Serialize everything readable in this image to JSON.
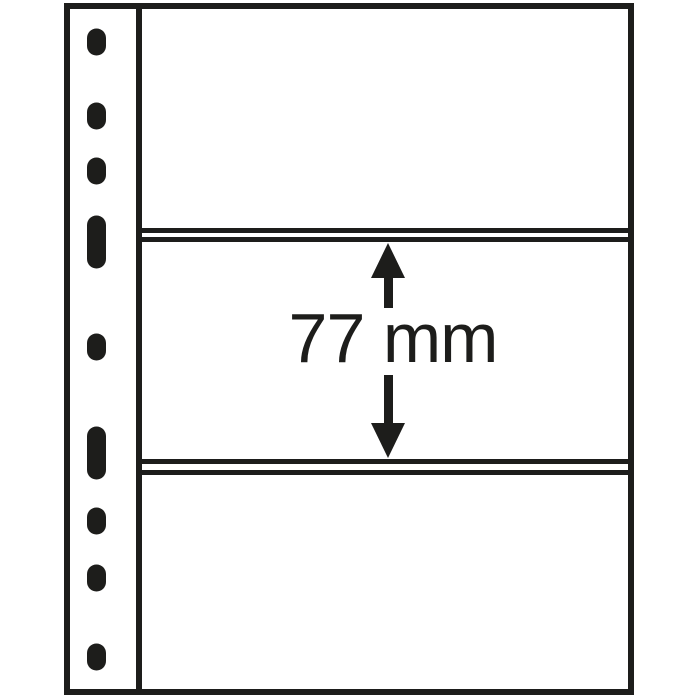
{
  "page": {
    "background_color": "#ffffff",
    "ink_color": "#1d1d1b"
  },
  "dimension_annotation": {
    "label": "77 mm"
  },
  "punch_strip": {
    "hole_count": 9,
    "holes": [
      {
        "type": "round",
        "cy": 42
      },
      {
        "type": "round",
        "cy": 116
      },
      {
        "type": "round",
        "cy": 171
      },
      {
        "type": "slot",
        "cy": 242
      },
      {
        "type": "round",
        "cy": 347
      },
      {
        "type": "slot",
        "cy": 453
      },
      {
        "type": "round",
        "cy": 521
      },
      {
        "type": "round",
        "cy": 578
      },
      {
        "type": "round",
        "cy": 657
      }
    ]
  }
}
